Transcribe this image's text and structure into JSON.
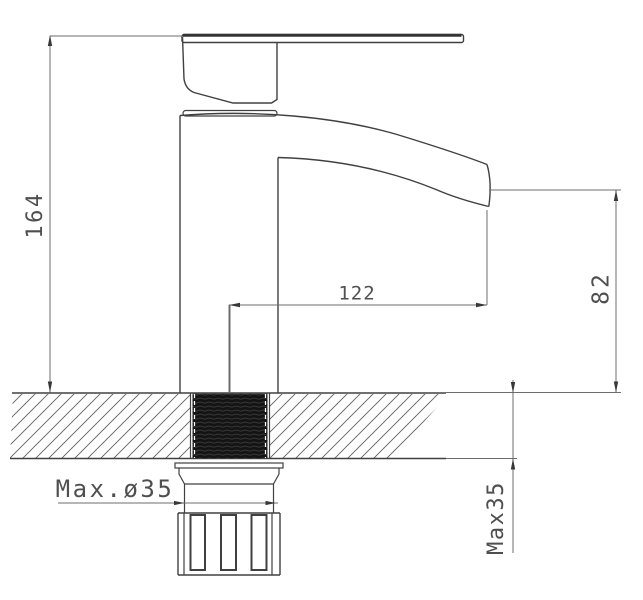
{
  "labels": {
    "total_height": "164",
    "spout_reach": "122",
    "outlet_height": "82",
    "max_hole_diameter": "Max.ø35",
    "max_mounting_thickness": "Max35"
  },
  "colors": {
    "background": "#ffffff",
    "outline": "#404040",
    "dimension_line": "#6d6d6d",
    "text": "#4f4f4f",
    "thread_fill": "#141414"
  }
}
